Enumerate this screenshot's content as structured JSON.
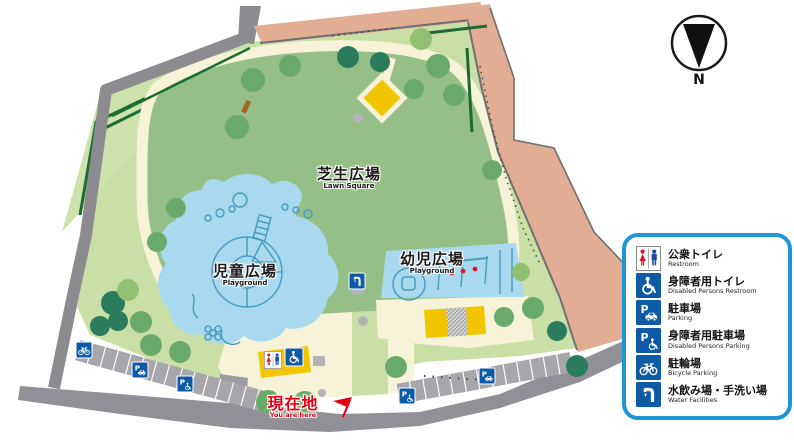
{
  "map": {
    "compass_label": "N",
    "areas": {
      "lawn": {
        "ja": "芝生広場",
        "en": "Lawn Square"
      },
      "children_playground": {
        "ja": "児童広場",
        "en": "Playground"
      },
      "toddler_playground": {
        "ja": "幼児広場",
        "en": "Playground"
      }
    },
    "current_location": {
      "ja": "現在地",
      "en": "You are here"
    }
  },
  "legend": {
    "items": [
      {
        "ja": "公衆トイレ",
        "en": "Restroom",
        "icon": "restroom-icon"
      },
      {
        "ja": "身障者用トイレ",
        "en": "Disabled Persons Restroom",
        "icon": "disabled-restroom-icon"
      },
      {
        "ja": "駐車場",
        "en": "Parking",
        "icon": "parking-icon"
      },
      {
        "ja": "身障者用駐車場",
        "en": "Disabled Persons Parking",
        "icon": "disabled-parking-icon"
      },
      {
        "ja": "駐輪場",
        "en": "Bicycle Parking",
        "icon": "bicycle-parking-icon"
      },
      {
        "ja": "水飲み場・手洗い場",
        "en": "Water Facilities",
        "icon": "water-facilities-icon"
      }
    ]
  },
  "colors": {
    "legend_border": "#1e96d6",
    "icon_blue": "#0d5ba7",
    "lawn_green": "#95bf86",
    "ground_green": "#cadfa6",
    "path_cream": "#f6f3d8",
    "water_blue": "#a9d9ef",
    "road_gray": "#8d8d92",
    "road_salmon": "#e2ae93",
    "building_yellow": "#f2c500",
    "accent_red": "#e60012"
  }
}
